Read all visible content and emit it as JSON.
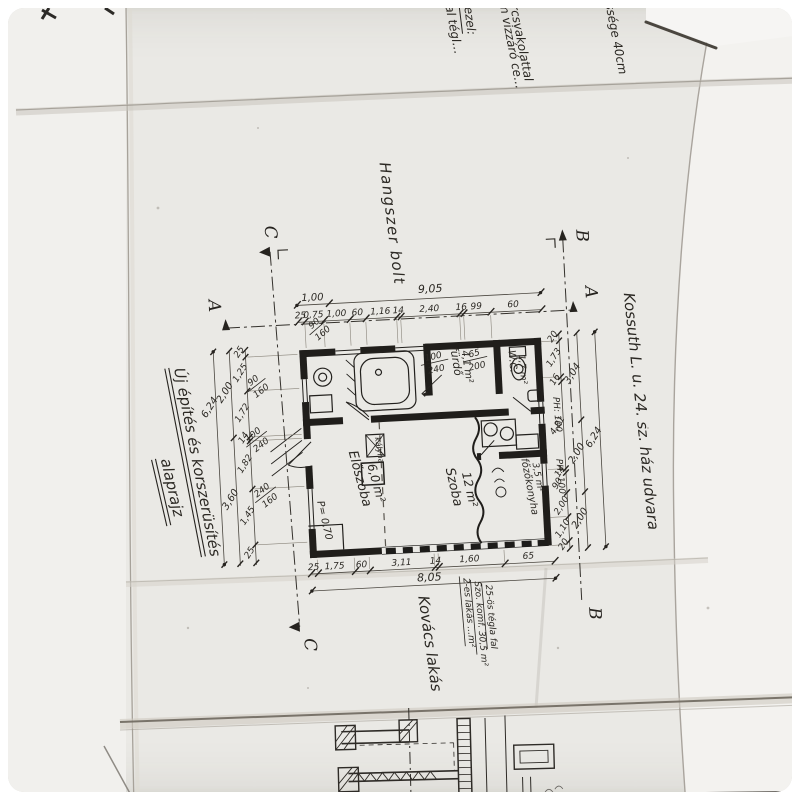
{
  "titles": {
    "project": "Új építés és korszerüsítés",
    "drawing": "alaprajz"
  },
  "labels": {
    "street": "Kossuth L. u. 24. sz. ház udvara",
    "shop": "Hangszer bolt",
    "resident": "Kovács lakás"
  },
  "notes_top": {
    "a": "…alakisztásával tégl…",
    "b": "…cetonfödém vizzáró ce…",
    "c": "…orcsvakolattal",
    "d": "…ezel:",
    "e": "…szélessége 40cm"
  },
  "notes_bottom": {
    "a": "2-es lakás …m²",
    "b": "Szo. komf. 30,5 m²",
    "c": "25-ös tégla fal"
  },
  "rooms": {
    "hall": {
      "name": "Előszoba",
      "area": "6,0 m²"
    },
    "living": {
      "name": "Szoba",
      "area": "12 m²"
    },
    "bath": {
      "name": "fürdő",
      "area": "4,1 m²"
    },
    "wc": {
      "name": "W.C.",
      "area": "1,7 m²"
    },
    "kitchen": {
      "name": "főzőkonyha",
      "area": "3,5 m²"
    },
    "stove": {
      "name": "kályha"
    }
  },
  "levels": {
    "floor": "P= 0,70",
    "parapet": "PH: 100"
  },
  "openings": {
    "window_small": {
      "w": "90",
      "h": "160"
    },
    "entry_door": {
      "w": "100",
      "h": "240"
    },
    "window_large": {
      "w": "240",
      "h": "160"
    },
    "bath_door": {
      "w": "100",
      "h": "240"
    },
    "wc_door": {
      "w": "65",
      "h": "200"
    }
  },
  "dims_top": {
    "total_left": "1,00",
    "total_right": "9,05",
    "chain": [
      "25",
      "0,75",
      "1,00",
      "60",
      "1,16",
      "14",
      "2,40",
      "16",
      "99",
      "60"
    ]
  },
  "dims_left": {
    "chain": [
      "25",
      "1,25",
      "1,72",
      "14",
      "1,82",
      "1,45",
      "25"
    ],
    "mid": [
      "2,00",
      "3,60"
    ],
    "total": "6,24"
  },
  "dims_right": {
    "chain": [
      "20",
      "1,73",
      "16",
      "4,81",
      "14",
      "90",
      "2,00",
      "1,10"
    ],
    "mid": [
      "3,04",
      "2,00",
      "2,00"
    ],
    "total": "6,24",
    "end": "20"
  },
  "dims_bottom": {
    "chain": [
      "25",
      "1,75",
      "60",
      "3,11",
      "14",
      "1,60",
      "65"
    ],
    "total": "8,05"
  },
  "markers": {
    "a": "A",
    "b": "B",
    "c": "C"
  }
}
